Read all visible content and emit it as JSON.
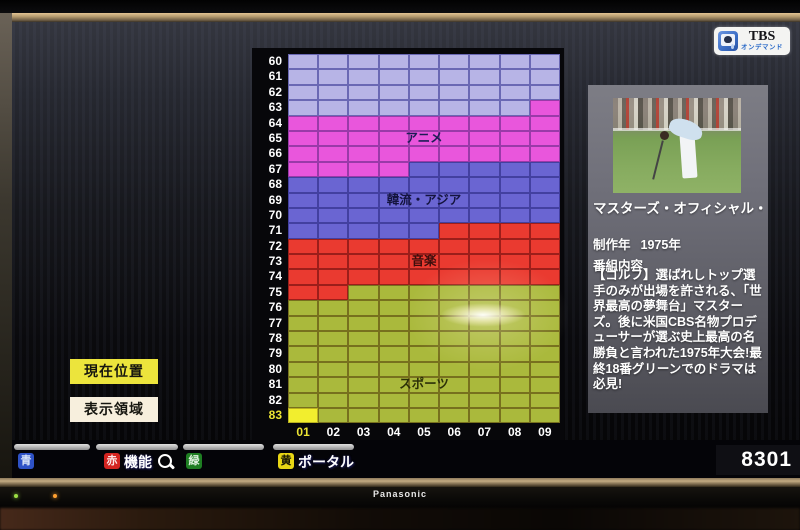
{
  "logo": {
    "brand": "TBS",
    "sub": "オンデマンド"
  },
  "left_buttons": {
    "current_position": "現在位置",
    "display_area": "表示領域"
  },
  "grid": {
    "col_labels": [
      "01",
      "02",
      "03",
      "04",
      "05",
      "06",
      "07",
      "08",
      "09"
    ],
    "highlight": {
      "row": "83",
      "col": "01"
    },
    "colors": {
      "c1": {
        "fill": "#b7b4e6",
        "line": "#6a68b4"
      },
      "c2": {
        "fill": "#e956dc",
        "line": "#9a3aa8"
      },
      "c3": {
        "fill": "#6a65d2",
        "line": "#4340a0"
      },
      "c4": {
        "fill": "#ea3a30",
        "line": "#9c1e1a"
      },
      "c5": {
        "fill": "#aab93c",
        "line": "#77701e"
      },
      "hl": {
        "fill": "#f2ee2e",
        "line": "#b8b020"
      }
    },
    "rows": [
      {
        "label": "60",
        "spans": [
          [
            "c1",
            9
          ]
        ]
      },
      {
        "label": "61",
        "spans": [
          [
            "c1",
            9
          ]
        ]
      },
      {
        "label": "62",
        "spans": [
          [
            "c1",
            9
          ]
        ]
      },
      {
        "label": "63",
        "spans": [
          [
            "c1",
            8
          ],
          [
            "c2",
            1
          ]
        ]
      },
      {
        "label": "64",
        "spans": [
          [
            "c2",
            9
          ]
        ]
      },
      {
        "label": "65",
        "spans": [
          [
            "c2",
            9
          ]
        ],
        "region_label": "アニメ",
        "label_color": "#1c1c55"
      },
      {
        "label": "66",
        "spans": [
          [
            "c2",
            9
          ]
        ]
      },
      {
        "label": "67",
        "spans": [
          [
            "c2",
            4
          ],
          [
            "c3",
            5
          ]
        ]
      },
      {
        "label": "68",
        "spans": [
          [
            "c3",
            9
          ]
        ]
      },
      {
        "label": "69",
        "spans": [
          [
            "c3",
            9
          ]
        ],
        "region_label": "韓流・アジア",
        "label_color": "#14143e"
      },
      {
        "label": "70",
        "spans": [
          [
            "c3",
            9
          ]
        ]
      },
      {
        "label": "71",
        "spans": [
          [
            "c3",
            5
          ],
          [
            "c4",
            4
          ]
        ]
      },
      {
        "label": "72",
        "spans": [
          [
            "c4",
            9
          ]
        ]
      },
      {
        "label": "73",
        "spans": [
          [
            "c4",
            9
          ]
        ],
        "region_label": "音楽",
        "label_color": "#3c0e0c"
      },
      {
        "label": "74",
        "spans": [
          [
            "c4",
            9
          ]
        ]
      },
      {
        "label": "75",
        "spans": [
          [
            "c4",
            2
          ],
          [
            "c5",
            7
          ]
        ]
      },
      {
        "label": "76",
        "spans": [
          [
            "c5",
            9
          ]
        ]
      },
      {
        "label": "77",
        "spans": [
          [
            "c5",
            9
          ]
        ]
      },
      {
        "label": "78",
        "spans": [
          [
            "c5",
            9
          ]
        ]
      },
      {
        "label": "79",
        "spans": [
          [
            "c5",
            9
          ]
        ]
      },
      {
        "label": "80",
        "spans": [
          [
            "c5",
            9
          ]
        ]
      },
      {
        "label": "81",
        "spans": [
          [
            "c5",
            9
          ]
        ],
        "region_label": "スポーツ",
        "label_color": "#2c3008"
      },
      {
        "label": "82",
        "spans": [
          [
            "c5",
            9
          ]
        ]
      },
      {
        "label": "83",
        "spans": [
          [
            "hl",
            1
          ],
          [
            "c5",
            8
          ]
        ]
      }
    ]
  },
  "program": {
    "title": "マスターズ・オフィシャル・…",
    "year_label": "制作年",
    "year": "1975年",
    "content_label": "番組内容",
    "description": "【ゴルフ】選ばれしトップ選手のみが出場を許される、「世界最高の夢舞台」マスターズ。後に米国CBS名物プロデューサーが選ぶ史上最高の名勝負と言われた1975年大会!最終18番グリーンでのドラマは必見!",
    "thumbnail_timecode": "LIVE"
  },
  "bottom_bar": {
    "items": [
      {
        "key": "青",
        "key_color": "#2e52c6",
        "key_text_color": "#dce6f8",
        "label": ""
      },
      {
        "key": "赤",
        "key_color": "#d42420",
        "key_text_color": "#fce8e8",
        "label": "機能",
        "icon": "magnifier-icon"
      },
      {
        "key": "緑",
        "key_color": "#1e7e22",
        "key_text_color": "#e0f2e0",
        "label": ""
      },
      {
        "key": "黄",
        "key_color": "#e8d614",
        "key_text_color": "#151505",
        "label": "ポータル"
      }
    ],
    "channel_number": "8301"
  },
  "tv": {
    "brand": "Panasonic"
  }
}
